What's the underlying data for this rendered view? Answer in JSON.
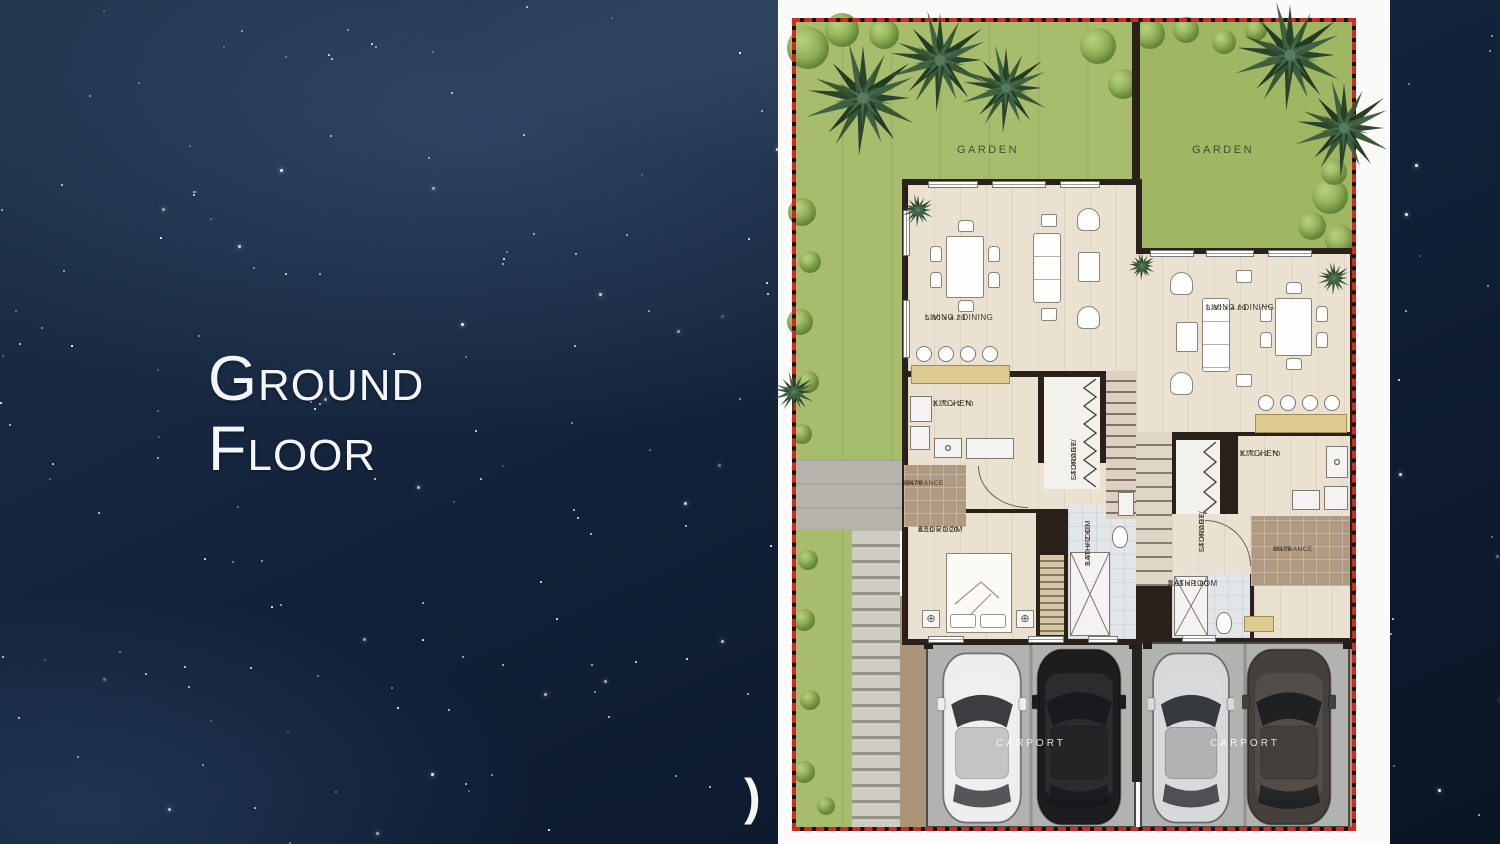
{
  "slide": {
    "title": "Ground\nFloor"
  },
  "stray_glyph": ")",
  "plan": {
    "units": [
      {
        "name": "left-unit",
        "garden": "GARDEN",
        "living_dining": {
          "label": "LIVING / DINING",
          "dims": "5.80 x 4.20"
        },
        "kitchen": {
          "label": "KITCHEN",
          "dims": "2.70 x 2.70"
        },
        "laundry": {
          "line1": "LAUNDRY/",
          "line2": "STORAGE"
        },
        "main_entrance": {
          "line1": "MAIN",
          "line2": "ENTRANCE"
        },
        "bedroom": {
          "label": "BEDROOM",
          "dims": "4.10 x 3.20"
        },
        "bathroom": {
          "label": "BATHROOM",
          "dims": "1.80 x 2.60"
        },
        "carport": "CARPORT"
      },
      {
        "name": "right-unit",
        "garden": "GARDEN",
        "living_dining": {
          "label": "LIVING / DINING",
          "dims": "5.80 x 4.00"
        },
        "kitchen": {
          "label": "KITCHEN",
          "dims": "2.70 x 2.70"
        },
        "laundry": {
          "line1": "LAUNDRY/",
          "line2": "STORAGE"
        },
        "main_entrance": {
          "line1": "MAIN",
          "line2": "ENTRANCE"
        },
        "bathroom": {
          "label": "BATHROOM",
          "dims": "2.95 x 1.60"
        },
        "carport": "CARPORT"
      }
    ],
    "colors": {
      "border_red": "#d22a23",
      "wall": "#2a221a",
      "floor": "#ebe1d0",
      "grass": "#a7bc6d",
      "car_white": "#eeeeee",
      "car_black": "#1d1d20",
      "car_silver": "#d6d8da",
      "car_gray": "#45403b"
    }
  }
}
